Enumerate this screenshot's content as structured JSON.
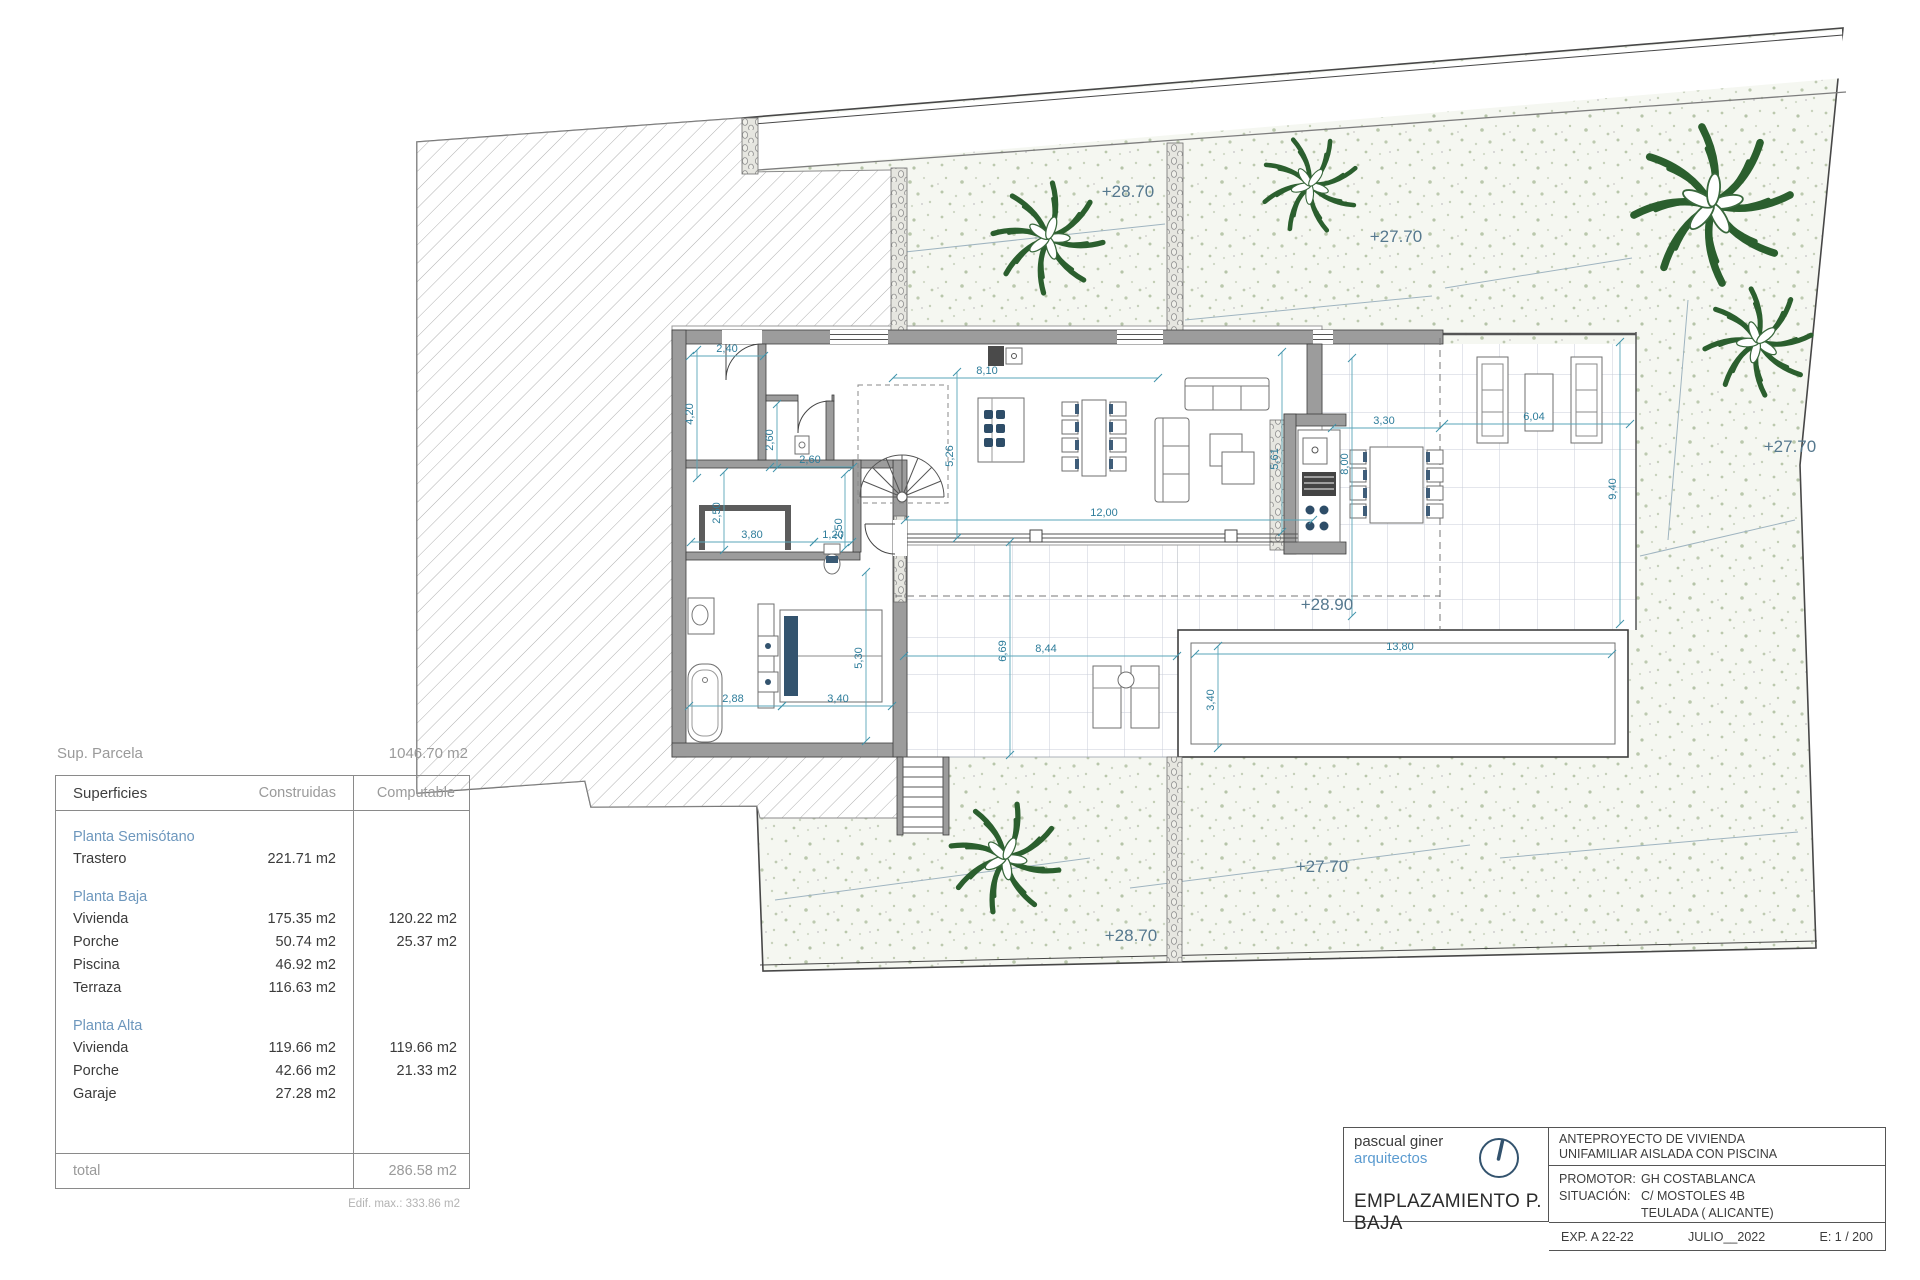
{
  "summary": {
    "parcel": {
      "label": "Sup. Parcela",
      "value": "1046.70 m2"
    },
    "table": {
      "col_label": "Superficies",
      "col_construidas": "Construidas",
      "col_computable": "Computable",
      "sections": [
        {
          "name": "Planta Semisótano",
          "rows": [
            [
              "Trastero",
              "221.71 m2",
              ""
            ]
          ]
        },
        {
          "name": "Planta Baja",
          "rows": [
            [
              "Vivienda",
              "175.35 m2",
              "120.22 m2"
            ],
            [
              "Porche",
              "50.74 m2",
              "25.37 m2"
            ],
            [
              "Piscina",
              "46.92 m2",
              ""
            ],
            [
              "Terraza",
              "116.63 m2",
              ""
            ]
          ]
        },
        {
          "name": "Planta Alta",
          "rows": [
            [
              "Vivienda",
              "119.66 m2",
              "119.66 m2"
            ],
            [
              "Porche",
              "42.66 m2",
              "21.33 m2"
            ],
            [
              "Garaje",
              "27.28 m2",
              ""
            ]
          ]
        }
      ],
      "total_label": "total",
      "total_value": "286.58 m2"
    },
    "footnote": "Edif. max.: 333.86 m2"
  },
  "plan": {
    "elevation_labels": [
      {
        "text": "+28.70",
        "x": 1128,
        "y": 197
      },
      {
        "text": "+27.70",
        "x": 1396,
        "y": 242
      },
      {
        "text": "+27.70",
        "x": 1790,
        "y": 452
      },
      {
        "text": "+28.90",
        "x": 1327,
        "y": 610
      },
      {
        "text": "+27.70",
        "x": 1322,
        "y": 872
      },
      {
        "text": "+28.70",
        "x": 1131,
        "y": 941
      }
    ],
    "dimension_labels": [
      {
        "text": "2,40",
        "x": 727,
        "y": 352,
        "rot": 0
      },
      {
        "text": "4,20",
        "x": 693,
        "y": 414,
        "rot": -90
      },
      {
        "text": "2,60",
        "x": 773,
        "y": 440,
        "rot": -90
      },
      {
        "text": "2,60",
        "x": 810,
        "y": 463,
        "rot": 0
      },
      {
        "text": "5,26",
        "x": 953,
        "y": 456,
        "rot": -90
      },
      {
        "text": "8,10",
        "x": 987,
        "y": 374,
        "rot": 0
      },
      {
        "text": "12,00",
        "x": 1104,
        "y": 516,
        "rot": 0
      },
      {
        "text": "5,61",
        "x": 1278,
        "y": 459,
        "rot": -90
      },
      {
        "text": "8,00",
        "x": 1348,
        "y": 464,
        "rot": -90
      },
      {
        "text": "3,30",
        "x": 1384,
        "y": 424,
        "rot": 0
      },
      {
        "text": "6,04",
        "x": 1534,
        "y": 420,
        "rot": 0
      },
      {
        "text": "9,40",
        "x": 1616,
        "y": 489,
        "rot": -90
      },
      {
        "text": "6,69",
        "x": 1006,
        "y": 651,
        "rot": -90
      },
      {
        "text": "8,44",
        "x": 1046,
        "y": 652,
        "rot": 0
      },
      {
        "text": "3,40",
        "x": 1214,
        "y": 700,
        "rot": -90
      },
      {
        "text": "13,80",
        "x": 1400,
        "y": 650,
        "rot": 0
      },
      {
        "text": "2,88",
        "x": 733,
        "y": 702,
        "rot": 0
      },
      {
        "text": "3,40",
        "x": 838,
        "y": 702,
        "rot": 0
      },
      {
        "text": "5,30",
        "x": 862,
        "y": 658,
        "rot": -90
      },
      {
        "text": "3,80",
        "x": 752,
        "y": 538,
        "rot": 0
      },
      {
        "text": "1,20",
        "x": 833,
        "y": 538,
        "rot": 0
      },
      {
        "text": "2,50",
        "x": 720,
        "y": 513,
        "rot": -90
      },
      {
        "text": "2,50",
        "x": 842,
        "y": 529,
        "rot": -90
      }
    ]
  },
  "titleblock": {
    "firm_name": "pascual giner",
    "firm_subtitle": "arquitectos",
    "sheet_title": "EMPLAZAMIENTO P. BAJA",
    "project_line1": "ANTEPROYECTO  DE VIVIENDA",
    "project_line2": "UNIFAMILIAR AISLADA CON PISCINA",
    "promoter_label": "PROMOTOR:",
    "promoter": "GH COSTABLANCA",
    "situation_label": "SITUACIÓN:",
    "situation1": "C/ MOSTOLES 4B",
    "situation2": "TEULADA  ( ALICANTE)",
    "exp": "EXP. A 22-22",
    "date": "JULIO__2022",
    "scale": "E: 1 / 200"
  }
}
